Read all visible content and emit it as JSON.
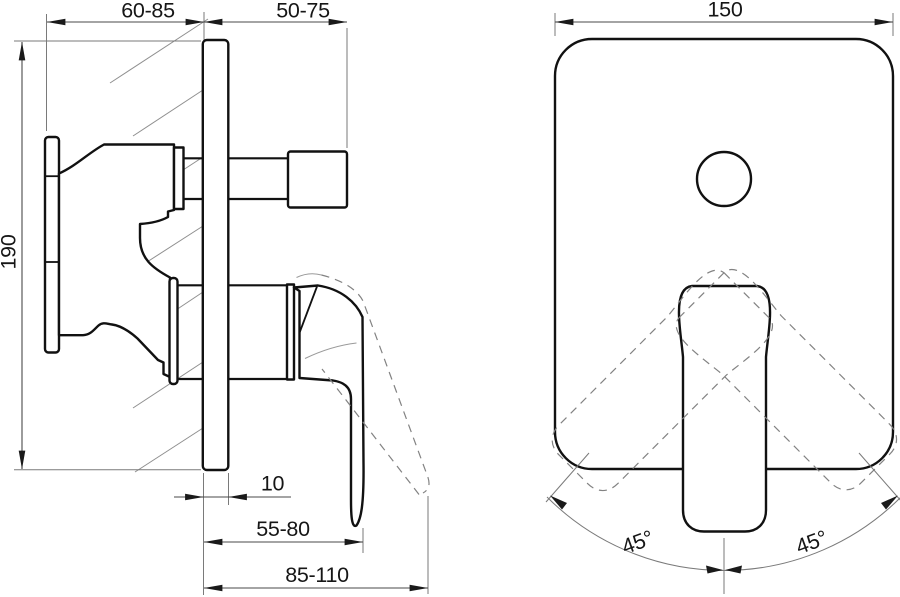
{
  "drawing": {
    "side_view": {
      "dim_depth_behind_wall": "60-85",
      "dim_depth_in_front": "50-75",
      "dim_body_height": "190",
      "dim_plate_thickness": "10",
      "dim_handle_reach_min": "55-80",
      "dim_handle_reach_max": "85-110"
    },
    "front_view": {
      "dim_plate_width": "150",
      "dim_swing_angle_left": "45°",
      "dim_swing_angle_right": "45°"
    },
    "colors": {
      "outline": "#111111",
      "dimension_line": "#4a4a4a",
      "hatch_line": "#8f8f8f",
      "ghost_line": "#828282",
      "text": "#161616",
      "background": "#ffffff"
    }
  }
}
